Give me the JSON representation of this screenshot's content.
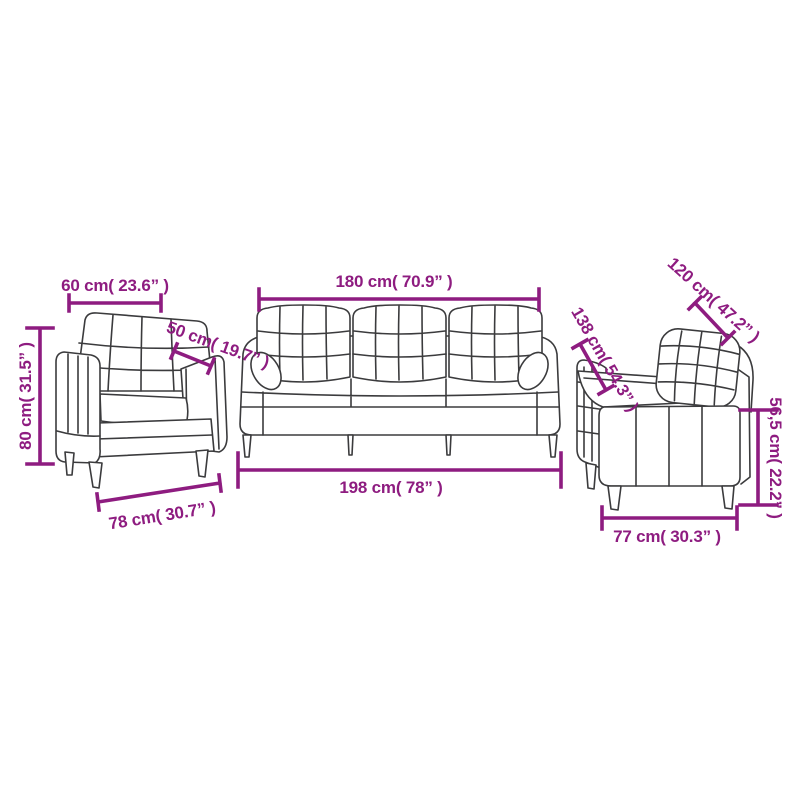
{
  "colors": {
    "accent": "#8E1C80",
    "line_art": "#3B3B3D",
    "background": "#FFFFFF"
  },
  "armchair": {
    "width_label": "60 cm( 23.6” )",
    "depth_label": "50 cm( 19.7” )",
    "height_label": "80 cm( 31.5” )",
    "base_label": "78 cm( 30.7” )"
  },
  "sofa_three": {
    "width_label": "180 cm( 70.9” )",
    "base_label": "198 cm( 78” )"
  },
  "sofa_two": {
    "back_width_label": "120 cm( 47.2” )",
    "length_label": "138 cm( 54.3” )",
    "height_label": "56,5 cm( 22.2” )",
    "depth_label": "77 cm( 30.3” )"
  }
}
